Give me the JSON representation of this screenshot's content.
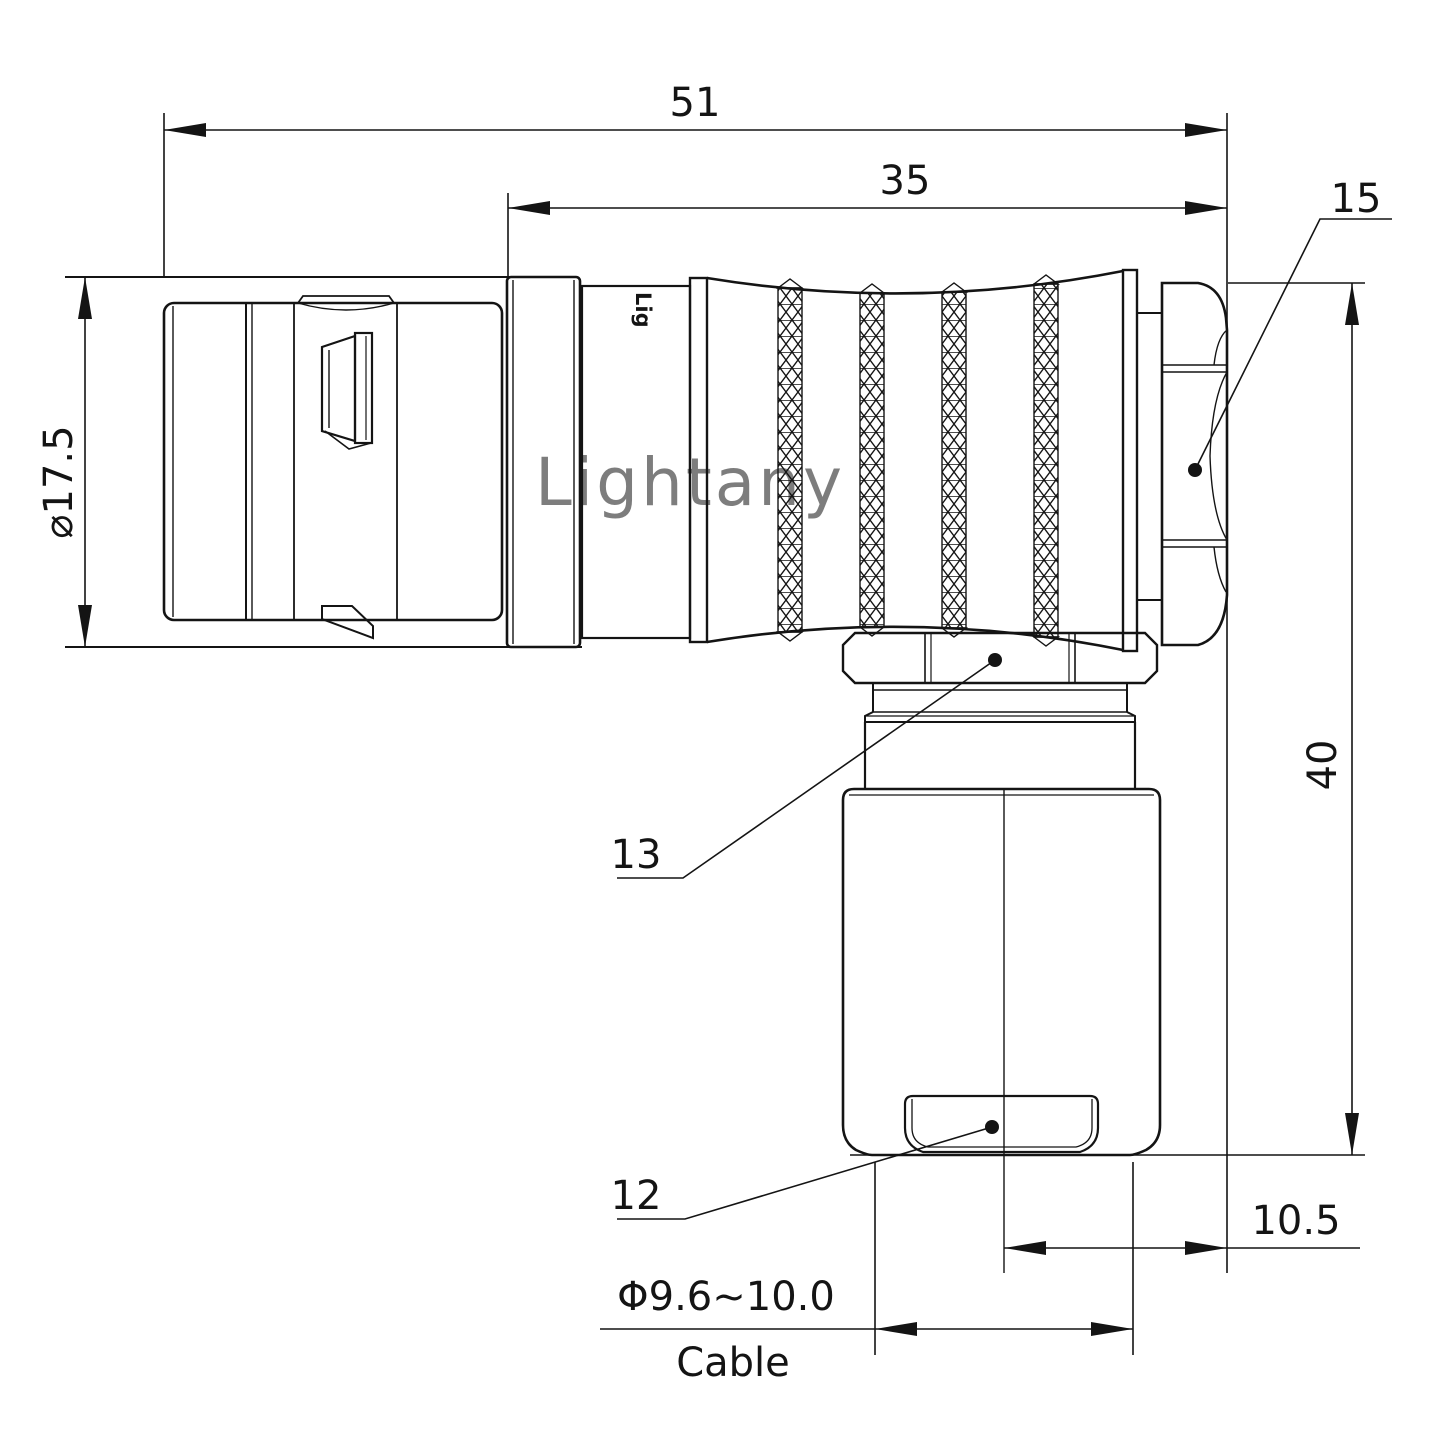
{
  "drawing": {
    "watermark": "Lightany",
    "engraving": "Lig",
    "dimensions": {
      "overall_length": "51",
      "grip_length": "35",
      "shell_diameter": "⌀17.5",
      "height": "40",
      "offset": "10.5",
      "cable_diameter": "Φ9.6~10.0",
      "cable_label": "Cable"
    },
    "part_labels": {
      "coupling_nut": "15",
      "gland_nut": "13",
      "cable_cap": "12"
    },
    "colors": {
      "line": "#141414",
      "watermark": "#edb9b9",
      "background": "#ffffff"
    }
  }
}
